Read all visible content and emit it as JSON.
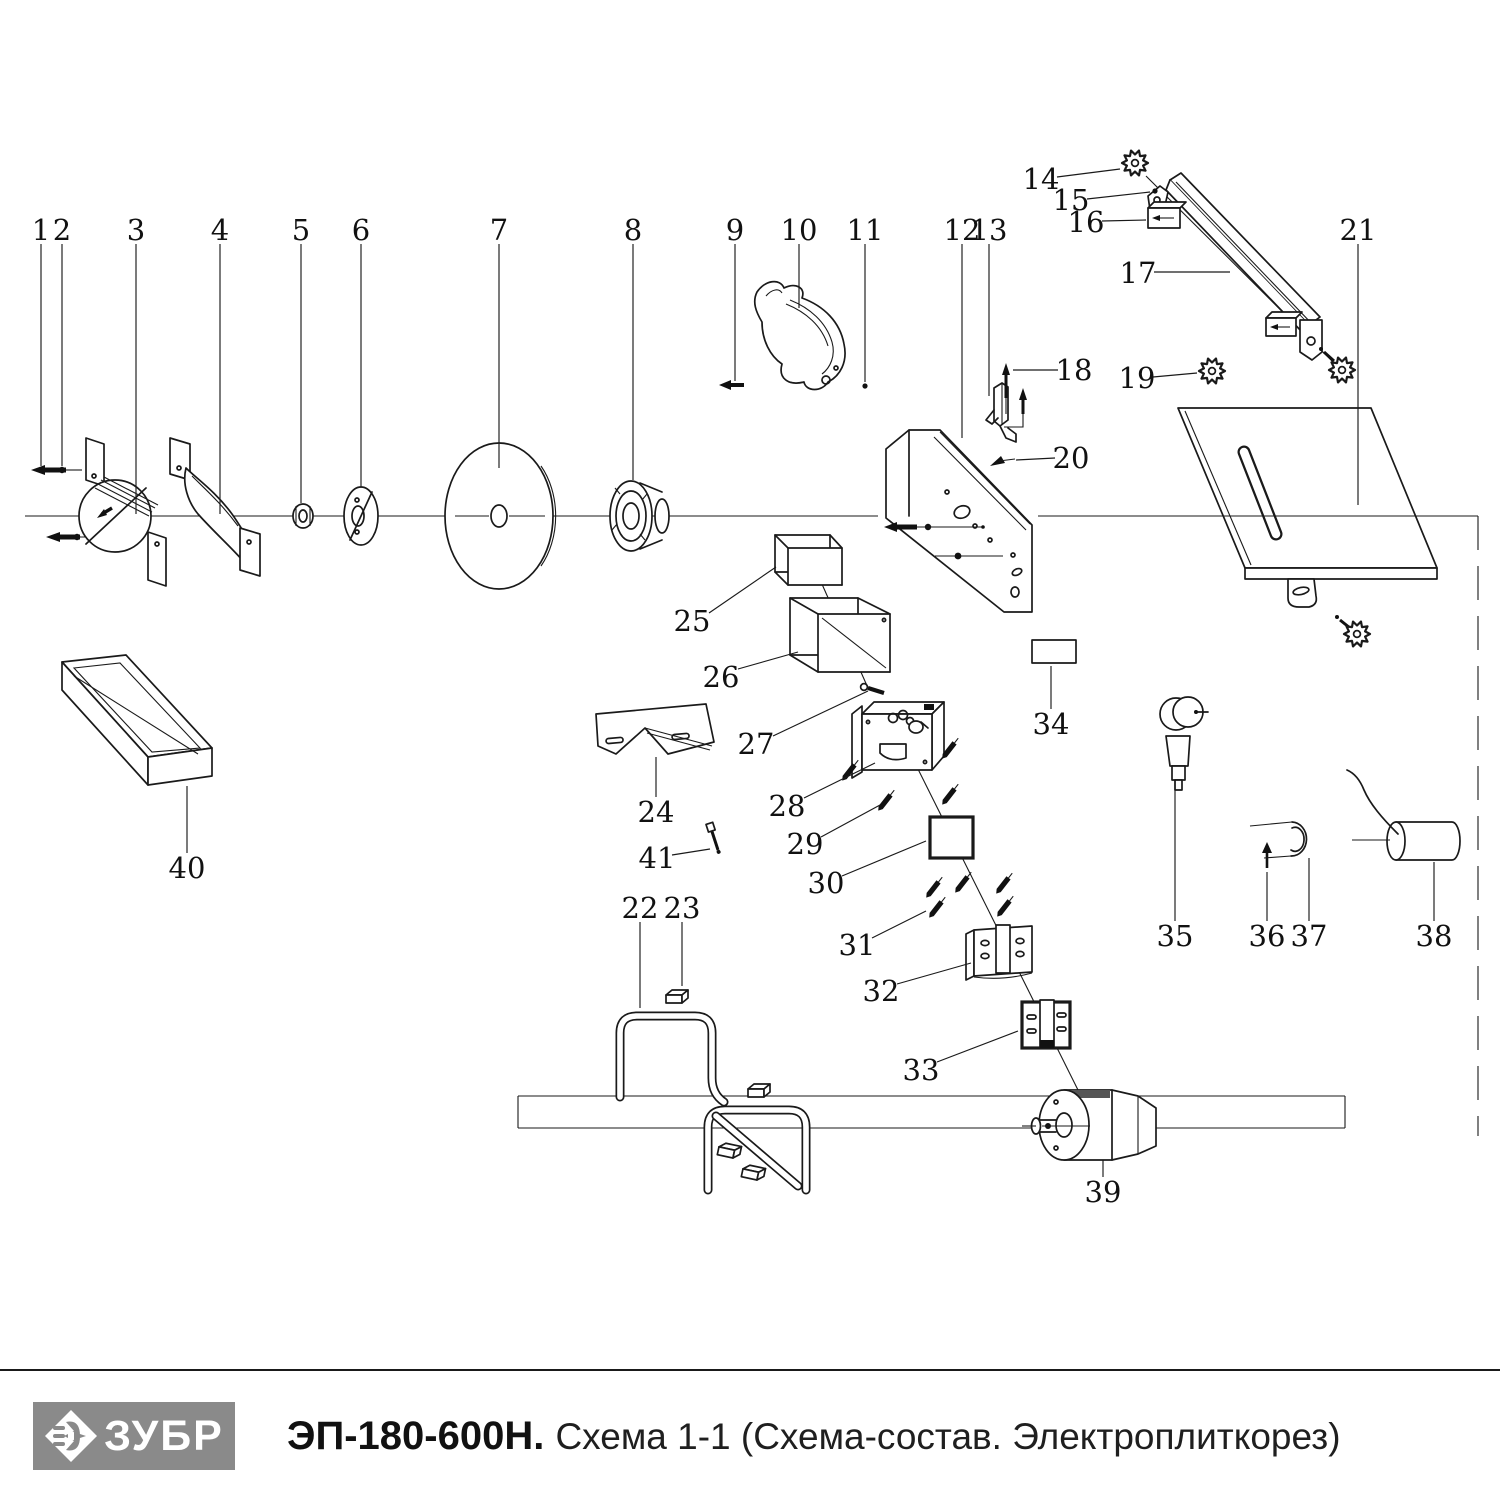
{
  "footer": {
    "brand": "ЗУБР",
    "model": "ЭП-180-600Н.",
    "subtitle": "Схема 1-1 (Схема-состав. Электроплиткорез)",
    "logo_bg": "#8a8a8a"
  },
  "diagram": {
    "stroke": "#1a1a1a",
    "parts": [
      {
        "num": "1",
        "x": 41,
        "y": 230,
        "leader": [
          41,
          244,
          41,
          466
        ]
      },
      {
        "num": "2",
        "x": 62,
        "y": 230,
        "leader": [
          62,
          244,
          62,
          466
        ]
      },
      {
        "num": "3",
        "x": 136,
        "y": 230,
        "leader": [
          136,
          244,
          136,
          514
        ]
      },
      {
        "num": "4",
        "x": 220,
        "y": 230,
        "leader": [
          220,
          244,
          220,
          514
        ]
      },
      {
        "num": "5",
        "x": 301,
        "y": 230,
        "leader": [
          301,
          244,
          301,
          503
        ]
      },
      {
        "num": "6",
        "x": 361,
        "y": 230,
        "leader": [
          361,
          244,
          361,
          487
        ]
      },
      {
        "num": "7",
        "x": 499,
        "y": 230,
        "leader": [
          499,
          244,
          499,
          468
        ]
      },
      {
        "num": "8",
        "x": 633,
        "y": 230,
        "leader": [
          633,
          244,
          633,
          480
        ]
      },
      {
        "num": "9",
        "x": 735,
        "y": 230,
        "leader": [
          735,
          244,
          735,
          381
        ]
      },
      {
        "num": "10",
        "x": 799,
        "y": 230,
        "leader": [
          799,
          244,
          799,
          308
        ]
      },
      {
        "num": "11",
        "x": 865,
        "y": 230,
        "leader": [
          865,
          244,
          865,
          382
        ]
      },
      {
        "num": "12",
        "x": 962,
        "y": 230,
        "leader": [
          962,
          244,
          962,
          438
        ]
      },
      {
        "num": "13",
        "x": 989,
        "y": 230,
        "leader": [
          989,
          244,
          989,
          396
        ]
      },
      {
        "num": "14",
        "x": 1041,
        "y": 179,
        "leader": [
          1057,
          177,
          1120,
          169
        ]
      },
      {
        "num": "15",
        "x": 1071,
        "y": 200,
        "leader": [
          1087,
          199,
          1150,
          192
        ]
      },
      {
        "num": "16",
        "x": 1086,
        "y": 222,
        "leader": [
          1102,
          221,
          1146,
          220
        ]
      },
      {
        "num": "17",
        "x": 1138,
        "y": 273,
        "leader": [
          1154,
          272,
          1230,
          272
        ]
      },
      {
        "num": "18",
        "x": 1074,
        "y": 370,
        "leader": [
          1058,
          370,
          1013,
          370
        ]
      },
      {
        "num": "19",
        "x": 1137,
        "y": 378,
        "leader": [
          1153,
          377,
          1197,
          373
        ]
      },
      {
        "num": "20",
        "x": 1071,
        "y": 458,
        "leader": [
          1055,
          458,
          1016,
          460
        ]
      },
      {
        "num": "21",
        "x": 1358,
        "y": 230,
        "leader": [
          1358,
          244,
          1358,
          505
        ]
      },
      {
        "num": "22",
        "x": 640,
        "y": 908,
        "leader": [
          640,
          922,
          640,
          1008
        ]
      },
      {
        "num": "23",
        "x": 682,
        "y": 908,
        "leader": [
          682,
          922,
          682,
          986
        ]
      },
      {
        "num": "24",
        "x": 656,
        "y": 812,
        "leader": [
          656,
          797,
          656,
          757
        ]
      },
      {
        "num": "25",
        "x": 692,
        "y": 621,
        "leader": [
          709,
          613,
          776,
          567
        ]
      },
      {
        "num": "26",
        "x": 721,
        "y": 677,
        "leader": [
          738,
          669,
          798,
          652
        ]
      },
      {
        "num": "27",
        "x": 756,
        "y": 744,
        "leader": [
          773,
          736,
          868,
          691
        ]
      },
      {
        "num": "28",
        "x": 787,
        "y": 806,
        "leader": [
          804,
          798,
          875,
          763
        ]
      },
      {
        "num": "29",
        "x": 805,
        "y": 844,
        "leader": [
          821,
          837,
          880,
          805
        ]
      },
      {
        "num": "30",
        "x": 826,
        "y": 883,
        "leader": [
          842,
          876,
          926,
          841
        ]
      },
      {
        "num": "31",
        "x": 857,
        "y": 945,
        "leader": [
          872,
          938,
          926,
          911
        ]
      },
      {
        "num": "32",
        "x": 881,
        "y": 991,
        "leader": [
          897,
          984,
          971,
          963
        ]
      },
      {
        "num": "33",
        "x": 921,
        "y": 1070,
        "leader": [
          937,
          1062,
          1018,
          1031
        ]
      },
      {
        "num": "34",
        "x": 1051,
        "y": 724,
        "leader": [
          1051,
          709,
          1051,
          666
        ]
      },
      {
        "num": "35",
        "x": 1175,
        "y": 936,
        "leader": [
          1175,
          921,
          1175,
          780
        ]
      },
      {
        "num": "36",
        "x": 1267,
        "y": 936,
        "leader": [
          1267,
          921,
          1267,
          872
        ]
      },
      {
        "num": "37",
        "x": 1309,
        "y": 936,
        "leader": [
          1309,
          921,
          1309,
          858
        ]
      },
      {
        "num": "38",
        "x": 1434,
        "y": 936,
        "leader": [
          1434,
          921,
          1434,
          862
        ]
      },
      {
        "num": "39",
        "x": 1103,
        "y": 1192,
        "leader": [
          1103,
          1177,
          1103,
          1160
        ]
      },
      {
        "num": "40",
        "x": 187,
        "y": 868,
        "leader": [
          187,
          853,
          187,
          786
        ]
      },
      {
        "num": "41",
        "x": 657,
        "y": 858,
        "leader": [
          672,
          855,
          710,
          849
        ]
      }
    ]
  }
}
